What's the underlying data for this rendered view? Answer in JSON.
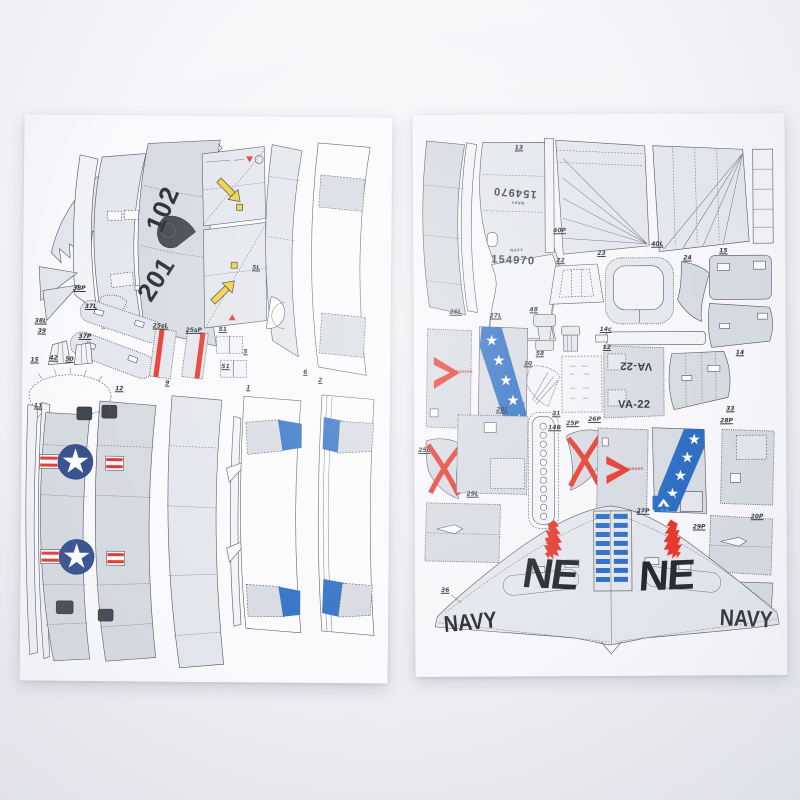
{
  "product_photo": {
    "description_colors": {
      "insignia_blue": "#35508f",
      "flash_blue": "#2e6fc4",
      "marking_red": "#e5382d",
      "arrow_yellow": "#f2cf3c"
    },
    "left_sheet": {
      "modex_top": "102",
      "modex_bottom": "201",
      "part_labels": [
        "38P",
        "38L",
        "39",
        "37L",
        "37P",
        "15",
        "42",
        "50",
        "25sL",
        "25sP",
        "S1",
        "S1",
        "5L",
        "5",
        "6",
        "11",
        "12",
        "9",
        "1",
        "2"
      ]
    },
    "right_sheet": {
      "buno_inverted": "154970",
      "buno": "154970",
      "buno_small_text": "NAVY",
      "squadron_inverted": "VA-22",
      "squadron": "VA-22",
      "tail_code_left": "NE",
      "tail_code_right": "NE",
      "wing_navy_left": "NAVY",
      "wing_navy_right": "NAVY",
      "danger_left": "DANGER",
      "danger_right": "DANGER",
      "part_labels": [
        "13",
        "40P",
        "40L",
        "22",
        "23",
        "24",
        "15",
        "14",
        "14c",
        "12",
        "48",
        "58",
        "30",
        "31",
        "14B",
        "26L",
        "27L",
        "25L",
        "28L",
        "25P",
        "26P",
        "27P",
        "28P",
        "33",
        "29L",
        "29P",
        "20P",
        "36"
      ]
    }
  }
}
